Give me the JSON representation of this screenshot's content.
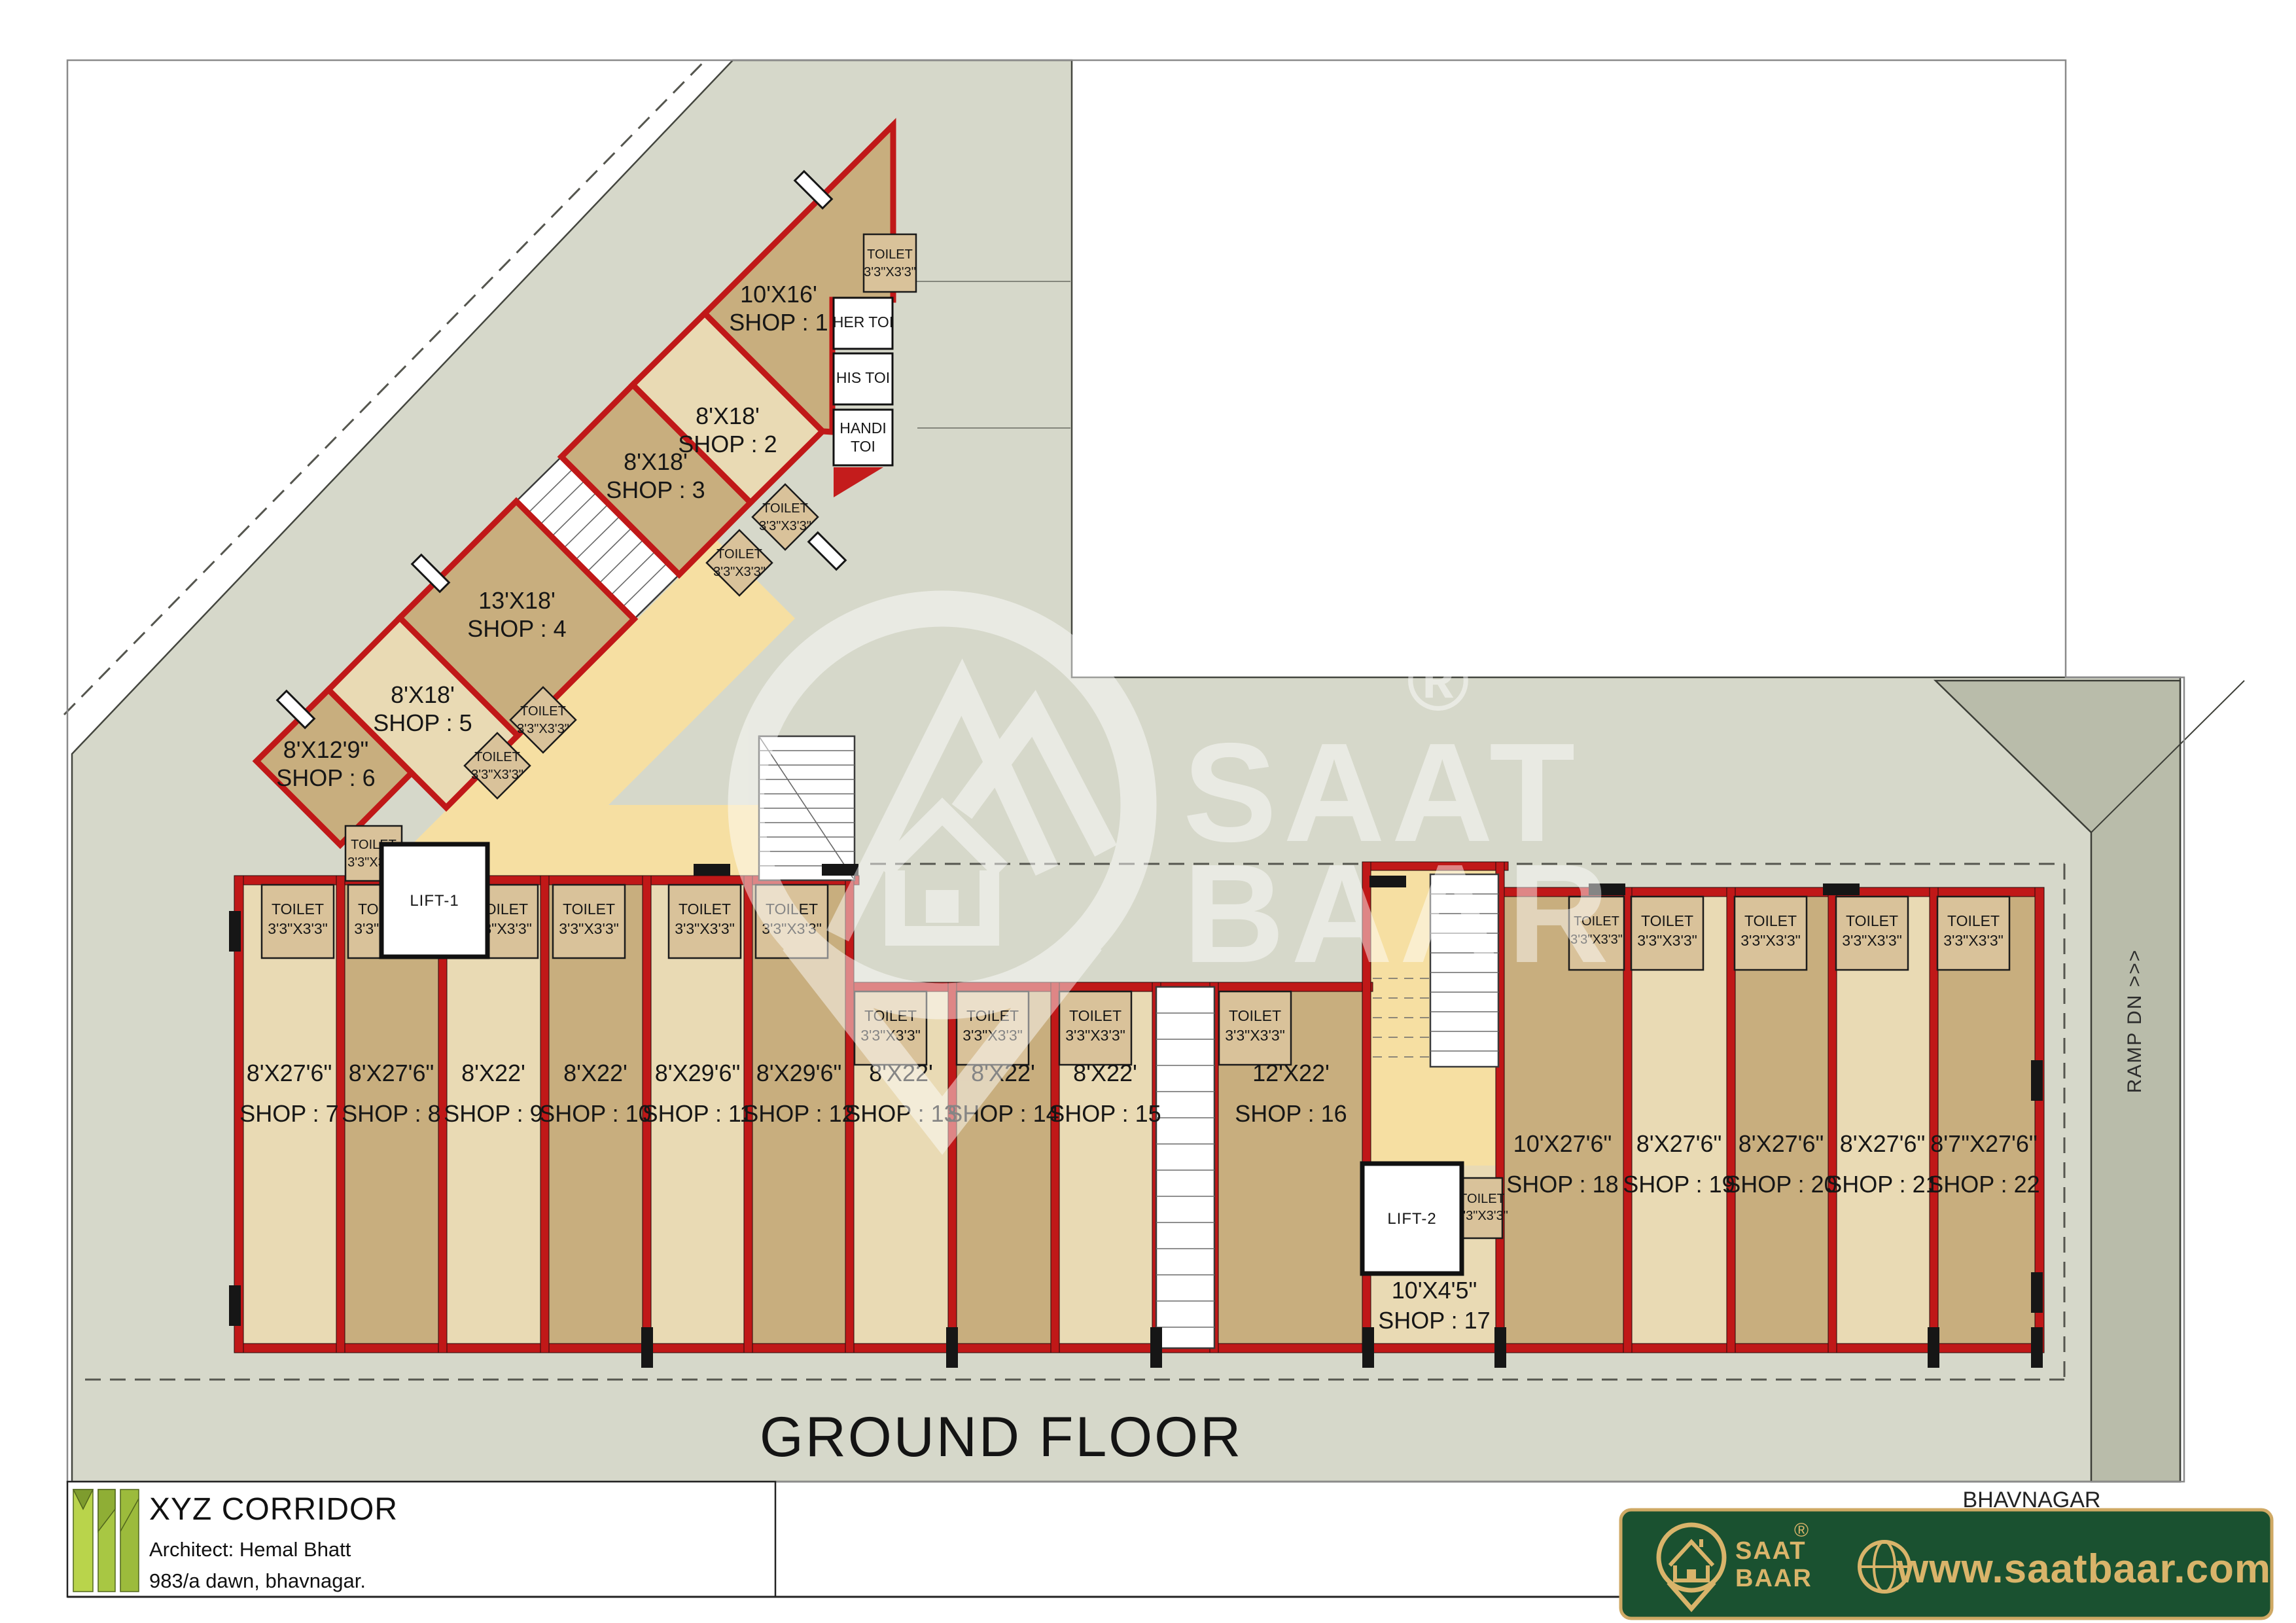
{
  "title": "GROUND FLOOR",
  "ramp": "RAMP DN  >>>",
  "toilet": {
    "line1": "TOILET",
    "line2": "3'3\"X3'3\""
  },
  "tip_toilets": {
    "her": "HER TOI",
    "his": "HIS TOI",
    "handi_1": "HANDI",
    "handi_2": "TOI"
  },
  "lifts": {
    "lift1": "LIFT-1",
    "lift2": "LIFT-2"
  },
  "watermark": {
    "line1": "SAAT",
    "line2": "BAAR",
    "reg": "®"
  },
  "shops": [
    {
      "num": "1",
      "size": "10'X16'",
      "name": "SHOP : 1"
    },
    {
      "num": "2",
      "size": "8'X18'",
      "name": "SHOP : 2"
    },
    {
      "num": "3",
      "size": "8'X18'",
      "name": "SHOP : 3"
    },
    {
      "num": "4",
      "size": "13'X18'",
      "name": "SHOP : 4"
    },
    {
      "num": "5",
      "size": "8'X18'",
      "name": "SHOP : 5"
    },
    {
      "num": "6",
      "size": "8'X12'9\"",
      "name": "SHOP : 6"
    },
    {
      "num": "7",
      "size": "8'X27'6\"",
      "name": "SHOP : 7"
    },
    {
      "num": "8",
      "size": "8'X27'6\"",
      "name": "SHOP : 8"
    },
    {
      "num": "9",
      "size": "8'X22'",
      "name": "SHOP : 9"
    },
    {
      "num": "10",
      "size": "8'X22'",
      "name": "SHOP : 10"
    },
    {
      "num": "11",
      "size": "8'X29'6\"",
      "name": "SHOP : 11"
    },
    {
      "num": "12",
      "size": "8'X29'6\"",
      "name": "SHOP : 12"
    },
    {
      "num": "13",
      "size": "8'X22'",
      "name": "SHOP : 13"
    },
    {
      "num": "14",
      "size": "8'X22'",
      "name": "SHOP : 14"
    },
    {
      "num": "15",
      "size": "8'X22'",
      "name": "SHOP : 15"
    },
    {
      "num": "16",
      "size": "12'X22'",
      "name": "SHOP : 16"
    },
    {
      "num": "17",
      "size": "10'X4'5\"",
      "name": "SHOP : 17"
    },
    {
      "num": "18",
      "size": "10'X27'6\"",
      "name": "SHOP : 18"
    },
    {
      "num": "19",
      "size": "8'X27'6\"",
      "name": "SHOP : 19"
    },
    {
      "num": "20",
      "size": "8'X27'6\"",
      "name": "SHOP : 20"
    },
    {
      "num": "21",
      "size": "8'X27'6\"",
      "name": "SHOP : 21"
    },
    {
      "num": "22",
      "size": "8'7\"X27'6\"",
      "name": "SHOP : 22"
    }
  ],
  "footer": {
    "project": "XYZ CORRIDOR",
    "architect": "Architect: Hemal Bhatt",
    "address": "983/a dawn, bhavnagar.",
    "city": "BHAVNAGAR",
    "brand": {
      "name1": "SAAT",
      "name2": "BAAR",
      "reg": "®",
      "website": "www.saatbaar.com"
    }
  },
  "colors": {
    "wall_red": "#c01818",
    "shop_dark_tan": "#c8ae7e",
    "shop_light_tan": "#e9dab4",
    "corridor_yellow": "#f6dfa2",
    "plot_gray": "#d6d8ca",
    "ramp_gray": "#b9bcaa",
    "banner_green": "#1a5130",
    "banner_gold": "#d9b46a",
    "logo_green": "#a8c743"
  }
}
